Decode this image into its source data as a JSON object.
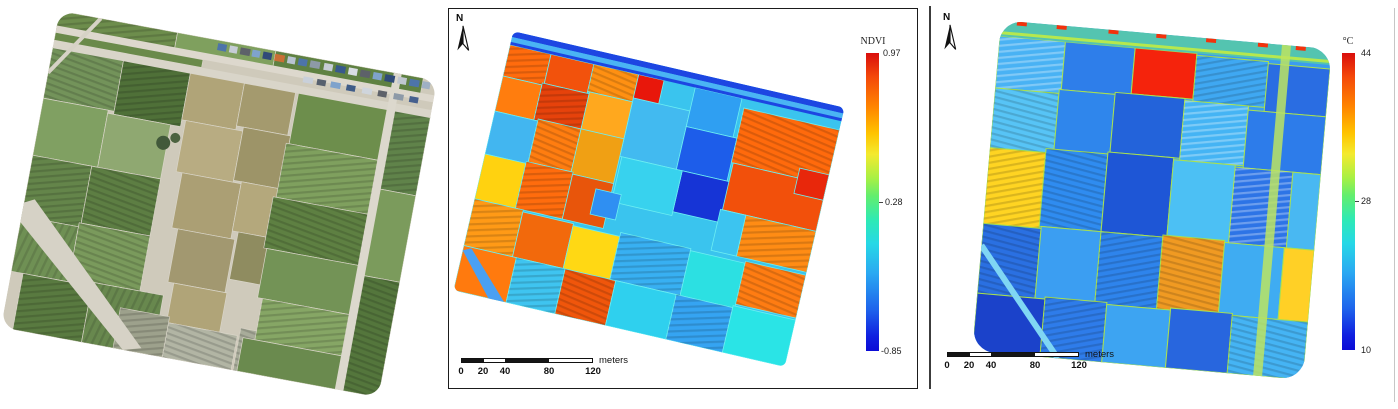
{
  "north_label": "N",
  "panels": {
    "rgb": {
      "kind": "uav-rgb-orthomosaic"
    },
    "ndvi": {
      "colorbar_title": "NDVI",
      "tick_top": "0.97",
      "tick_mid": "0.28",
      "tick_bottom": "-0.85"
    },
    "thermal": {
      "colorbar_title": "°C",
      "tick_top": "44",
      "tick_mid": "28",
      "tick_bottom": "10"
    }
  },
  "scalebar": {
    "ticks": [
      "0",
      "20",
      "40",
      "80",
      "120"
    ],
    "unit": "meters"
  },
  "icons": {
    "north_arrow": "compass-north-arrow"
  },
  "colors": {
    "colormap_name": "jet",
    "colormap_top_to_bottom": [
      "#d90e0c",
      "#ff8400",
      "#ffc400",
      "#a8f044",
      "#2eeab4",
      "#26d8e6",
      "#2aa8f2",
      "#1e64ec",
      "#0b0bd6"
    ],
    "ndvi_panel_border": "#1b1b1b",
    "scalebar_black": "#151515"
  }
}
